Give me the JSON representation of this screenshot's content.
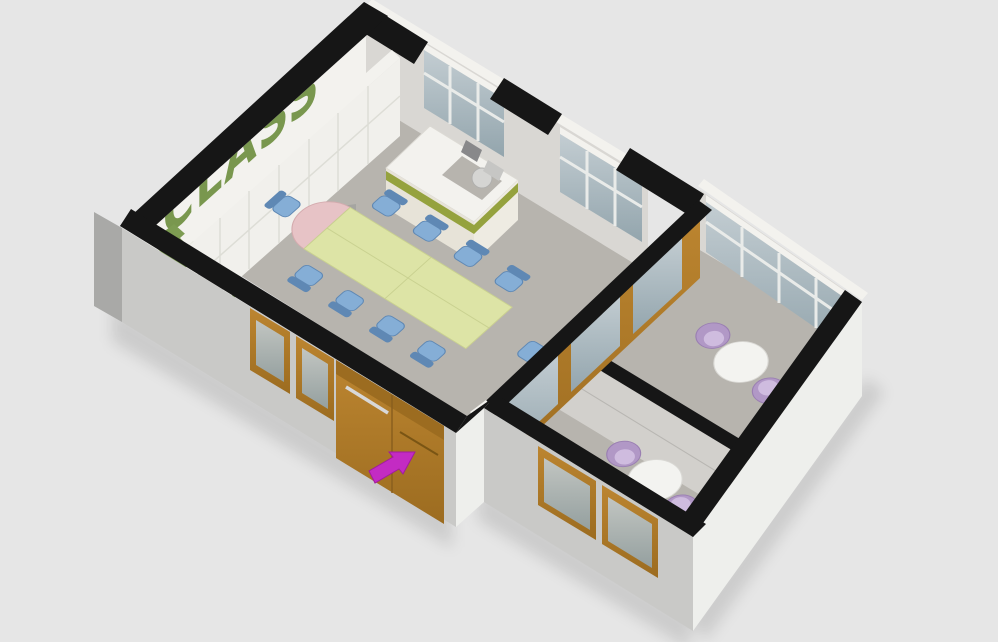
{
  "title": "3D isometric floor plan render",
  "wall_text": {
    "label": "CLASS",
    "color": "#6f9040"
  },
  "colors": {
    "background": "#e6e6e6",
    "wall_top": "#161616",
    "wall_outer": "#c9c9c7",
    "wall_outer_bright": "#eeefec",
    "wall_outer_side": "#a9a9a7",
    "wall_inner": "#d9d7d3",
    "wall_white": "#f3f2ee",
    "floor": "#b7b4ae",
    "floor_green": "#7d9c52",
    "cabinet": "#f1f0ec",
    "cabinet_line": "#ddddd6",
    "wood": "#bc8530",
    "wood_dark": "#9c6c20",
    "glass_light": "#c3cdd2",
    "glass_dark": "#93a5ad",
    "frame_white": "#e9ebe9",
    "desk_stripe": "#95a23e",
    "text_green": "#6f9040",
    "table_green": "#dde4a6",
    "table_green_edge": "#c9d190",
    "table_pink": "#e7c3c6",
    "chair_blue": "#85aed6",
    "chair_blue_dark": "#5f88b4",
    "chair_purple": "#b198c6",
    "chair_purple_light": "#cfbcdf",
    "small_table": "#f3f3f0",
    "small_table_edge": "#d9d8d4",
    "metal": "#d8d8d8",
    "monitor": "#88888a",
    "arrow": "#c32bc3"
  },
  "scene": {
    "type": "3d-floorplan-render",
    "rooms": [
      {
        "name": "main classroom",
        "furniture": [
          "oval conference table with green top and pink rounded ends",
          "10 blue chairs",
          "teacher desk with green stripe, office chair and monitor",
          "white cabinet wall with sink counter"
        ]
      },
      {
        "name": "meeting room 1",
        "furniture": [
          "round white table",
          "2 purple armchairs"
        ]
      },
      {
        "name": "meeting room 2",
        "furniture": [
          "round white table",
          "2 purple armchairs"
        ]
      }
    ],
    "annotations": [
      {
        "name": "entrance-arrow",
        "color": "#c32bc3",
        "points_to": "wooden entrance double door"
      }
    ]
  }
}
